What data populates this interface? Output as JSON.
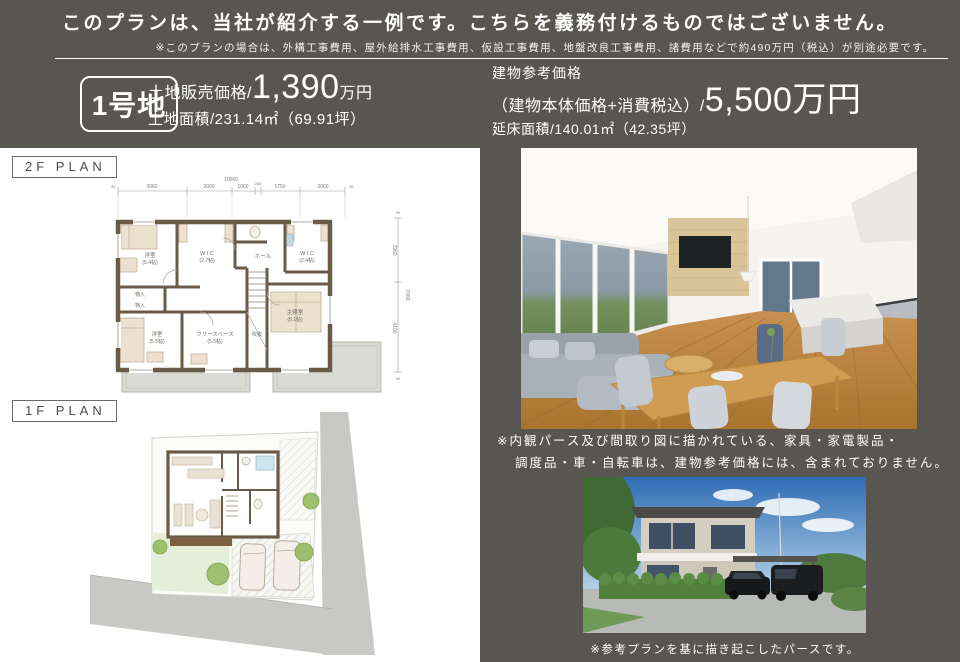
{
  "colors": {
    "band_dark": "#595651",
    "wall_brown": "#6a5b49",
    "floor_wood": "#c08a45",
    "garden_green": "#9cc06e"
  },
  "header": {
    "title": "このプランは、当社が紹介する一例です。こちらを義務付けるものではございません。",
    "note": "※このプランの場合は、外構工事費用、屋外給排水工事費用、仮設工事費用、地盤改良工事費用、諸費用などで約490万円（税込）が別途必要です。",
    "lot_badge": "1号地",
    "land": {
      "price_label": "土地販売価格/",
      "price_value": "1,390",
      "price_unit": "万円",
      "area": "土地面積/231.14㎡（69.91坪）"
    },
    "building": {
      "title": "建物参考価格",
      "price_prefix": "（建物本体価格+消費税込）/",
      "price_value": "5,500万円",
      "area": "延床面積/140.01㎡（42.35坪）"
    }
  },
  "plans": {
    "p2f_label": "2F PLAN",
    "p1f_label": "1F PLAN",
    "dims": {
      "top_total": "10060",
      "top_segments": [
        "3060",
        "2000",
        "1000",
        "250",
        "1750",
        "2000"
      ],
      "edge": "30",
      "side_total": "7060",
      "side_segments": [
        "2960",
        "4100"
      ]
    },
    "rooms_2f": {
      "bed1": {
        "name": "洋室",
        "size": "(5.4帖)"
      },
      "wic1": {
        "name": "W I C",
        "size": "(2.7帖)"
      },
      "hall": {
        "name": "ホール",
        "size": ""
      },
      "wic2": {
        "name": "W I C",
        "size": "(2.4帖)"
      },
      "closet1": {
        "name": "物入",
        "size": ""
      },
      "closet2": {
        "name": "物入",
        "size": ""
      },
      "bed2": {
        "name": "洋室",
        "size": "(5.5帖)"
      },
      "free": {
        "name": "フリースペース",
        "size": "(5.5帖)"
      },
      "void": {
        "name": "吹抜",
        "size": ""
      },
      "master": {
        "name": "主寝室",
        "size": "(8.1帖)"
      }
    }
  },
  "renders": {
    "interior_note_1": "※内観パース及び間取り図に描かれている、家具・家電製品・",
    "interior_note_2": "調度品・車・自転車は、建物参考価格には、含まれておりません。",
    "exterior_note": "※参考プランを基に描き起こしたパースです。"
  }
}
